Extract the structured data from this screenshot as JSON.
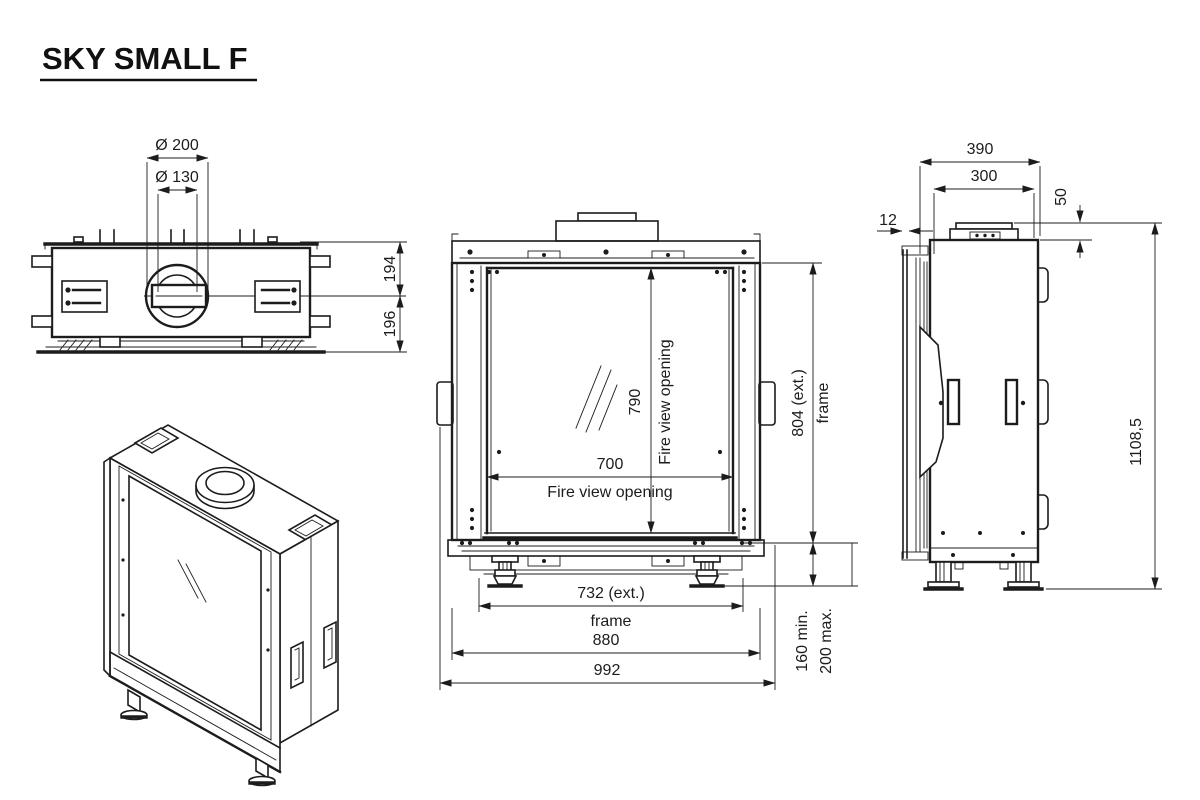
{
  "title": "SKY SMALL F",
  "colors": {
    "line": "#1c1c1c",
    "background": "#ffffff"
  },
  "dimensions": {
    "top_view": {
      "flue_outer_diameter": "Ø 200",
      "flue_inner_diameter": "Ø 130",
      "flue_center_from_front": "194",
      "flue_center_from_back": "196"
    },
    "front_view": {
      "opening_width": "700",
      "opening_width_caption": "Fire view opening",
      "opening_height": "790",
      "opening_height_caption": "Fire view opening",
      "frame_height": "804 (ext.)",
      "frame_height_caption": "frame",
      "frame_width": "732 (ext.)",
      "frame_width_caption": "frame",
      "body_width": "880",
      "overall_width": "992",
      "plinth_height_min": "160 min.",
      "plinth_height_max": "200 max."
    },
    "side_view": {
      "overall_depth": "390",
      "body_depth": "300",
      "frame_offset": "12",
      "collar_height": "50",
      "overall_height": "1108,5"
    }
  }
}
